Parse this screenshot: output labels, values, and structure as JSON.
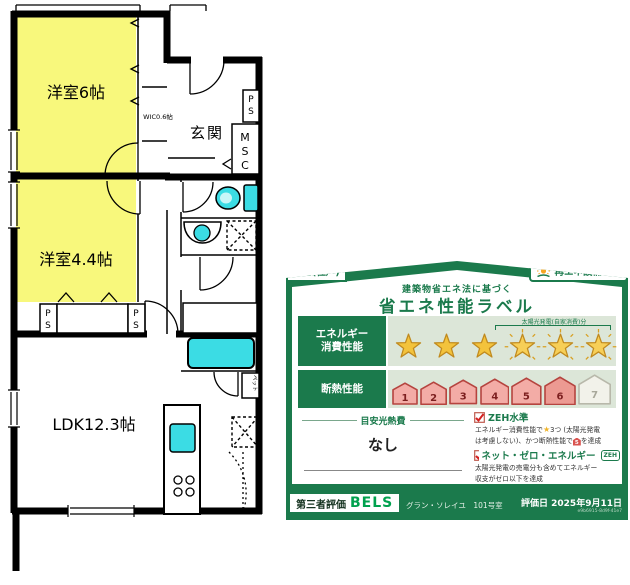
{
  "floor_plan": {
    "labels": {
      "bedroom1": "洋室6帖",
      "bedroom2": "洋室4.4帖",
      "ldk": "LDK12.3帖",
      "entrance": "玄関",
      "wic": "WIC0.6帖",
      "msc_letters": [
        "M",
        "S",
        "C"
      ],
      "ps_letters": [
        "P",
        "S"
      ],
      "pet": "ペット"
    },
    "colors": {
      "room_fill": "#F8F87C",
      "fixture_fill": "#3BDCE4",
      "wall": "#000000"
    }
  },
  "energy_label": {
    "type_badge": "住宅(住戸)",
    "renewable_badge": "再エネ設備あり",
    "law_note": "建築物省エネ法に基づく",
    "title": "省エネ性能ラベル",
    "energy_section": {
      "label_line1": "エネルギー",
      "label_line2": "消費性能",
      "stars_solid": 3,
      "stars_solar": 3,
      "stars_max": 6,
      "solar_note": "太陽光発電(自家消費)分"
    },
    "insulation_section": {
      "label": "断熱性能",
      "levels": [
        "1",
        "2",
        "3",
        "4",
        "5",
        "6",
        "7"
      ],
      "achieved": 6
    },
    "utility_cost": {
      "label": "目安光熱費",
      "value": "なし"
    },
    "zeh": {
      "label": "ZEH水準",
      "star_char": "★",
      "desc_pre": "エネルギー消費性能で",
      "desc_mid": "3つ (太陽光発電",
      "desc_line2_pre": "は考慮しない)、かつ断熱性能で",
      "grade_icon": "5",
      "desc_line2_post": "を達成"
    },
    "net_zero": {
      "label": "ネット・ゼロ・エネルギー",
      "badge": "ZEH",
      "desc_line1": "太陽光発電の売電分も含めてエネルギー",
      "desc_line2": "収支がゼロ以下を達成"
    },
    "footer": {
      "evaluator_label": "第三者評価",
      "evaluator_name": "BELS",
      "building": "グラン・ソレイユ　101号室",
      "date": "評価日 2025年9月11日",
      "code": "e9b6915-8d9f-41e7"
    },
    "colors": {
      "green": "#1B7A4C",
      "light_green_bg": "#DCE6D8",
      "star_gold": "#F3C33C",
      "house_pink": "#F3ACA6",
      "house_red": "#B5443F",
      "check_red": "#D42020"
    }
  }
}
